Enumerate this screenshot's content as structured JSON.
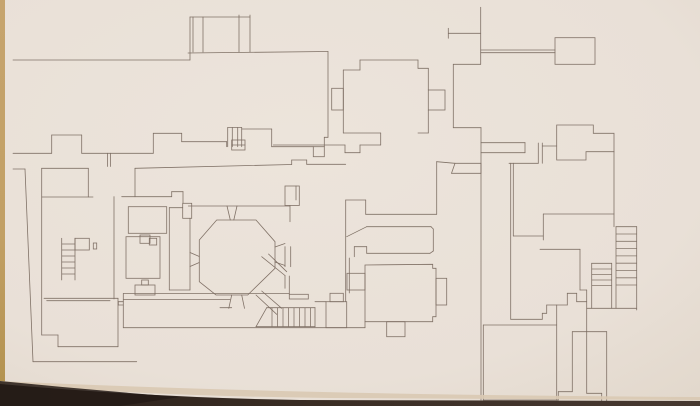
{
  "meta": {
    "description": "Photograph of a hand-drafted architectural floor plan (monastic/abbey ground plan) on cream paper; dark table edge visible along the bottom and a tan paper edge along the left.",
    "visible_text": ""
  },
  "palette": {
    "paper": "#eae1d8",
    "paper_edge_light": "#e3d9cd",
    "ink": "#7b6c61",
    "ink_dark": "#6a5c52",
    "left_border_tan": "#c6a46e",
    "left_border_tan_dark": "#b3924f",
    "bottom_shadow_dark": "#2b211b",
    "bottom_shadow_mid": "#473931",
    "bottom_paper_edge": "#d9c9b2"
  },
  "plan": {
    "canvas": [
      700,
      406
    ],
    "stroke_width": 0.8,
    "segments": [
      [
        13,
        60,
        190,
        60
      ],
      [
        190,
        60,
        190,
        17
      ],
      [
        190,
        17,
        250,
        17
      ],
      [
        193,
        17,
        193,
        52
      ],
      [
        203,
        17,
        203,
        52
      ],
      [
        239,
        15,
        239,
        52
      ],
      [
        250,
        15,
        250,
        52
      ],
      [
        188,
        53,
        328,
        51.5
      ],
      [
        328,
        51.5,
        328,
        137.3
      ],
      [
        328,
        137.3,
        324.3,
        137.3
      ],
      [
        324.3,
        137.3,
        324.3,
        146.7
      ],
      [
        271.7,
        146.7,
        313.3,
        146.7
      ],
      [
        271.7,
        129,
        271.7,
        146.7
      ],
      [
        241.7,
        129,
        271.7,
        129
      ],
      [
        227.7,
        127.5,
        227.7,
        146.7
      ],
      [
        232.3,
        127.5,
        232.3,
        146.7
      ],
      [
        237.7,
        127.5,
        237.7,
        146.7
      ],
      [
        241.7,
        127.5,
        241.7,
        146.7
      ],
      [
        227.7,
        127.5,
        241.7,
        127.5
      ],
      [
        231.7,
        145,
        245,
        145
      ],
      [
        13,
        153.3,
        51.7,
        153.3
      ],
      [
        51.7,
        153.3,
        51.7,
        135
      ],
      [
        51.7,
        135,
        81.7,
        135
      ],
      [
        81.7,
        135,
        81.7,
        153.3
      ],
      [
        81.7,
        153.3,
        153.3,
        153.3
      ],
      [
        107.5,
        153.3,
        107.5,
        166.5
      ],
      [
        110.5,
        153.3,
        110.5,
        166.5
      ],
      [
        153.3,
        153.3,
        153.3,
        133.3
      ],
      [
        153.3,
        133.3,
        181.7,
        133.3
      ],
      [
        181.7,
        133.3,
        181.7,
        141.7
      ],
      [
        181.7,
        141.7,
        226.7,
        141.7
      ],
      [
        226.7,
        141.7,
        226.7,
        146.7
      ],
      [
        135,
        168.3,
        291.7,
        164.5
      ],
      [
        291.7,
        164.5,
        291.7,
        160
      ],
      [
        291.7,
        160,
        306.7,
        160
      ],
      [
        306.7,
        160,
        306.7,
        164.3
      ],
      [
        306.7,
        164.3,
        345.7,
        164.3
      ],
      [
        135,
        168.3,
        135,
        196.7
      ],
      [
        121.7,
        196.7,
        171.7,
        196.7
      ],
      [
        171.7,
        196.7,
        171.7,
        191.7
      ],
      [
        171.7,
        191.7,
        183,
        191.7
      ],
      [
        183,
        191.7,
        183,
        203.3
      ],
      [
        273.3,
        145,
        345,
        145
      ],
      [
        345,
        145,
        345,
        152.7
      ],
      [
        345,
        152.7,
        360,
        152.7
      ],
      [
        360,
        152.7,
        360,
        145
      ],
      [
        360,
        145,
        380.7,
        145
      ],
      [
        380.7,
        145,
        380.7,
        133
      ],
      [
        360,
        60,
        418,
        60
      ],
      [
        418,
        60,
        418,
        68.3
      ],
      [
        418,
        68.3,
        428.3,
        68.3
      ],
      [
        428.3,
        68.3,
        428.3,
        90
      ],
      [
        428.3,
        110,
        428.3,
        133
      ],
      [
        343.3,
        133,
        380.7,
        133
      ],
      [
        418,
        133,
        428.3,
        133
      ],
      [
        360,
        60,
        360,
        70
      ],
      [
        343.3,
        70,
        360,
        70
      ],
      [
        343.3,
        70,
        343.3,
        133
      ],
      [
        448.3,
        28.3,
        448.3,
        38.3
      ],
      [
        448.3,
        33.3,
        480.7,
        33.3
      ],
      [
        480.7,
        7.3,
        480.7,
        64.3
      ],
      [
        480.7,
        50,
        555,
        50
      ],
      [
        480.7,
        52.7,
        555,
        52.7
      ],
      [
        453.3,
        64.3,
        480.7,
        64.3
      ],
      [
        453.3,
        64.3,
        453.3,
        127.7
      ],
      [
        453.3,
        127.7,
        481,
        127.7
      ],
      [
        436.7,
        161.7,
        436.7,
        214.3
      ],
      [
        436.7,
        161.7,
        455,
        163.3
      ],
      [
        345.7,
        200,
        365.7,
        200
      ],
      [
        365.7,
        200,
        365.7,
        214.3
      ],
      [
        365.7,
        214.3,
        436.7,
        214.3
      ],
      [
        345.7,
        200,
        345.7,
        301.7
      ],
      [
        349.3,
        258,
        349.3,
        293
      ],
      [
        346.7,
        236.7,
        366.7,
        226.7
      ],
      [
        366.7,
        226.7,
        431,
        226.7
      ],
      [
        431,
        226.7,
        433.3,
        229
      ],
      [
        433.3,
        229,
        433.3,
        251
      ],
      [
        433.3,
        251,
        430,
        253.3
      ],
      [
        366.7,
        253.3,
        430,
        253.3
      ],
      [
        366.7,
        253.3,
        366.7,
        246.7
      ],
      [
        354.3,
        246.7,
        366.7,
        246.7
      ],
      [
        354.3,
        246.7,
        354.3,
        256.7
      ],
      [
        188.3,
        206,
        290,
        206
      ],
      [
        290,
        205.7,
        290,
        221.7
      ],
      [
        296,
        186,
        296,
        200
      ],
      [
        285,
        246.7,
        285,
        266.7
      ],
      [
        290.7,
        246.7,
        290.7,
        266.7
      ],
      [
        227,
        206,
        230.3,
        220
      ],
      [
        237,
        206,
        233.8,
        220
      ],
      [
        190,
        252.5,
        199.3,
        256.5
      ],
      [
        190,
        266.5,
        199.3,
        262.5
      ],
      [
        275,
        247,
        285,
        243.5
      ],
      [
        275,
        262,
        285,
        265.5
      ],
      [
        231.7,
        295,
        228.8,
        308.3
      ],
      [
        241.7,
        295,
        244.5,
        308.3
      ],
      [
        114,
        196.7,
        114,
        299
      ],
      [
        169.3,
        207.7,
        169.3,
        290
      ],
      [
        190,
        218.3,
        190,
        290
      ],
      [
        169.3,
        207.7,
        182.7,
        207.7
      ],
      [
        169.3,
        290,
        190,
        290
      ],
      [
        13,
        169,
        25,
        169
      ],
      [
        25,
        169,
        33,
        361.7
      ],
      [
        33,
        361.7,
        136.7,
        361.7
      ],
      [
        41.7,
        168.3,
        41.7,
        335
      ],
      [
        41.7,
        168.3,
        88.3,
        168.3
      ],
      [
        88.3,
        168.3,
        88.3,
        197
      ],
      [
        41.7,
        197,
        93,
        197
      ],
      [
        41.7,
        335,
        58,
        335
      ],
      [
        58,
        335,
        58,
        346.7
      ],
      [
        58,
        346.7,
        118,
        346.7
      ],
      [
        118,
        346.7,
        118,
        298.3
      ],
      [
        44,
        298.3,
        118,
        298.3
      ],
      [
        46.7,
        300.7,
        110,
        300.7
      ],
      [
        61.7,
        238.3,
        61.7,
        280
      ],
      [
        75,
        238.3,
        75,
        280
      ],
      [
        123.3,
        293.5,
        289.3,
        293.5
      ],
      [
        123.3,
        299.5,
        230,
        299.5
      ],
      [
        220,
        307.7,
        231.7,
        307.7
      ],
      [
        118.3,
        301.7,
        123.3,
        301.7
      ],
      [
        118.3,
        301.7,
        118.3,
        305
      ],
      [
        118.3,
        305,
        123.3,
        305
      ],
      [
        123.3,
        293.5,
        123.3,
        327.7
      ],
      [
        123.3,
        327.7,
        365,
        327.7
      ],
      [
        365,
        321.7,
        365,
        327.7
      ],
      [
        266.7,
        307.7,
        315,
        307.7
      ],
      [
        315,
        307.7,
        315,
        326.7
      ],
      [
        256,
        326.7,
        315,
        326.7
      ],
      [
        256,
        326.7,
        266.7,
        307.7
      ],
      [
        261.7,
        256.7,
        285,
        275.5
      ],
      [
        268.5,
        254,
        286.7,
        271.7
      ],
      [
        285,
        275.5,
        285,
        288.3
      ],
      [
        289.3,
        276,
        289.3,
        294.3
      ],
      [
        256,
        295,
        276.7,
        314.3
      ],
      [
        261.7,
        291,
        281.7,
        308.3
      ],
      [
        315,
        301.7,
        326,
        301.7
      ],
      [
        481,
        127.7,
        481,
        400
      ],
      [
        481,
        142.7,
        525,
        142.7
      ],
      [
        481,
        152.7,
        525,
        152.7
      ],
      [
        525,
        142.7,
        525,
        152.7
      ],
      [
        538.3,
        143,
        538.3,
        163.3
      ],
      [
        542.3,
        143,
        542.3,
        163.3
      ],
      [
        542.3,
        146,
        556.7,
        146
      ],
      [
        614,
        151.7,
        614,
        226.7
      ],
      [
        509,
        163.3,
        538.3,
        163.3
      ],
      [
        510.7,
        163.3,
        510.7,
        319.3
      ],
      [
        513.3,
        163.3,
        513.3,
        236
      ],
      [
        513.3,
        236,
        543.3,
        236
      ],
      [
        510.7,
        319.3,
        542.3,
        319.3
      ],
      [
        543.3,
        214,
        614,
        214
      ],
      [
        543.3,
        214,
        543.3,
        240
      ],
      [
        540,
        249.3,
        580,
        249.3
      ],
      [
        580,
        249.3,
        580,
        290
      ],
      [
        580,
        290,
        586.7,
        290
      ],
      [
        586.7,
        290,
        586.7,
        331.7
      ],
      [
        542.3,
        313.3,
        546.7,
        313.3
      ],
      [
        546.7,
        305,
        546.7,
        313.3
      ],
      [
        546.7,
        305,
        567.3,
        305
      ],
      [
        542.3,
        313.3,
        542.3,
        319.3
      ],
      [
        567.3,
        293.3,
        567.3,
        305
      ],
      [
        576.7,
        293.3,
        576.7,
        301.7
      ],
      [
        567.3,
        293.3,
        576.7,
        293.3
      ],
      [
        576.7,
        301.7,
        586.7,
        301.7
      ],
      [
        616,
        226.7,
        616,
        308.3
      ],
      [
        636.7,
        226.7,
        636.7,
        310
      ],
      [
        616,
        226.7,
        636.7,
        226.7
      ],
      [
        586.7,
        308.3,
        636.7,
        308.3
      ],
      [
        591.7,
        263.3,
        591.7,
        308.3
      ],
      [
        611.7,
        263.3,
        611.7,
        308.3
      ],
      [
        591.7,
        263.3,
        611.7,
        263.3
      ],
      [
        483.3,
        325,
        483.3,
        400
      ],
      [
        483.3,
        325,
        556.7,
        325
      ],
      [
        556.7,
        305,
        556.7,
        400
      ],
      [
        483.3,
        400,
        558.3,
        400
      ],
      [
        490,
        404,
        545,
        404
      ],
      [
        558.3,
        391.7,
        572.3,
        391.7
      ],
      [
        572.3,
        331.7,
        572.3,
        391.7
      ],
      [
        558.3,
        391.7,
        558.3,
        400
      ],
      [
        572.3,
        331.7,
        586.7,
        331.7
      ],
      [
        586.7,
        331.7,
        606.7,
        331.7
      ],
      [
        586.7,
        331.7,
        586.7,
        393.3
      ],
      [
        586.7,
        393.3,
        601.7,
        393.3
      ],
      [
        606.7,
        331.7,
        606.7,
        401.7
      ],
      [
        601.7,
        393.3,
        601.7,
        401.7
      ],
      [
        601.7,
        401.7,
        606.7,
        401.7
      ]
    ],
    "rects": [
      [
        313.3,
        146.7,
        11,
        10
      ],
      [
        231.7,
        140,
        13.3,
        10
      ],
      [
        182.7,
        203.3,
        9,
        15
      ],
      [
        428.3,
        90,
        16.7,
        20
      ],
      [
        331.7,
        88.3,
        11.6,
        21.7
      ],
      [
        555,
        37.7,
        40,
        26.6
      ],
      [
        128.3,
        206.7,
        38.4,
        26.6
      ],
      [
        126,
        236.7,
        34,
        41.6
      ],
      [
        140,
        235,
        10,
        8.3
      ],
      [
        149.3,
        238.3,
        7.4,
        6.7
      ],
      [
        135,
        285,
        20,
        10
      ],
      [
        141.7,
        280,
        6.6,
        5
      ],
      [
        93.3,
        243,
        3.4,
        6
      ],
      [
        75,
        238.3,
        14.3,
        11.7
      ],
      [
        289.3,
        294.3,
        19,
        4.7
      ],
      [
        326,
        301.7,
        20.7,
        26
      ],
      [
        330,
        293.3,
        13.3,
        8.4
      ],
      [
        347,
        273.3,
        18,
        16.7
      ],
      [
        436,
        278.3,
        10.7,
        26.7
      ],
      [
        386.7,
        321.7,
        18.3,
        15
      ],
      [
        285,
        186,
        14.3,
        19.5
      ]
    ],
    "polygons": [
      [
        199.3,
        240,
        216.7,
        220,
        256,
        220,
        275,
        241.7,
        275,
        268.3,
        247.7,
        295,
        216,
        295,
        199.3,
        281.7
      ],
      [
        365,
        265,
        432.7,
        264.3,
        432.7,
        268.3,
        436,
        268.3,
        436,
        316.7,
        432.7,
        316.7,
        432.7,
        321.7,
        365,
        321.7
      ],
      [
        556.7,
        125,
        593.3,
        125,
        593.3,
        133.3,
        614,
        133.3,
        614,
        151.7,
        586,
        151.7,
        586,
        160,
        556.7,
        160
      ],
      [
        451.5,
        173.3,
        455,
        163.3,
        481,
        163.3,
        481,
        173.3
      ]
    ],
    "stair_runs": [
      {
        "orient": "h",
        "x1": 61.7,
        "x2": 75,
        "ys": [
          244,
          250,
          256,
          262,
          268,
          274
        ]
      },
      {
        "orient": "v",
        "y1": 307.7,
        "y2": 326.7,
        "xs": [
          272,
          277.5,
          283,
          288.5,
          294,
          299.5,
          305,
          310.5
        ]
      },
      {
        "orient": "h",
        "x1": 616,
        "x2": 636.7,
        "ys": [
          234,
          241.3,
          248.6,
          255.9,
          263.2,
          270.5,
          277.8,
          285
        ]
      },
      {
        "orient": "h",
        "x1": 591.7,
        "x2": 611.7,
        "ys": [
          269,
          274.5,
          280,
          285.5
        ]
      }
    ]
  }
}
